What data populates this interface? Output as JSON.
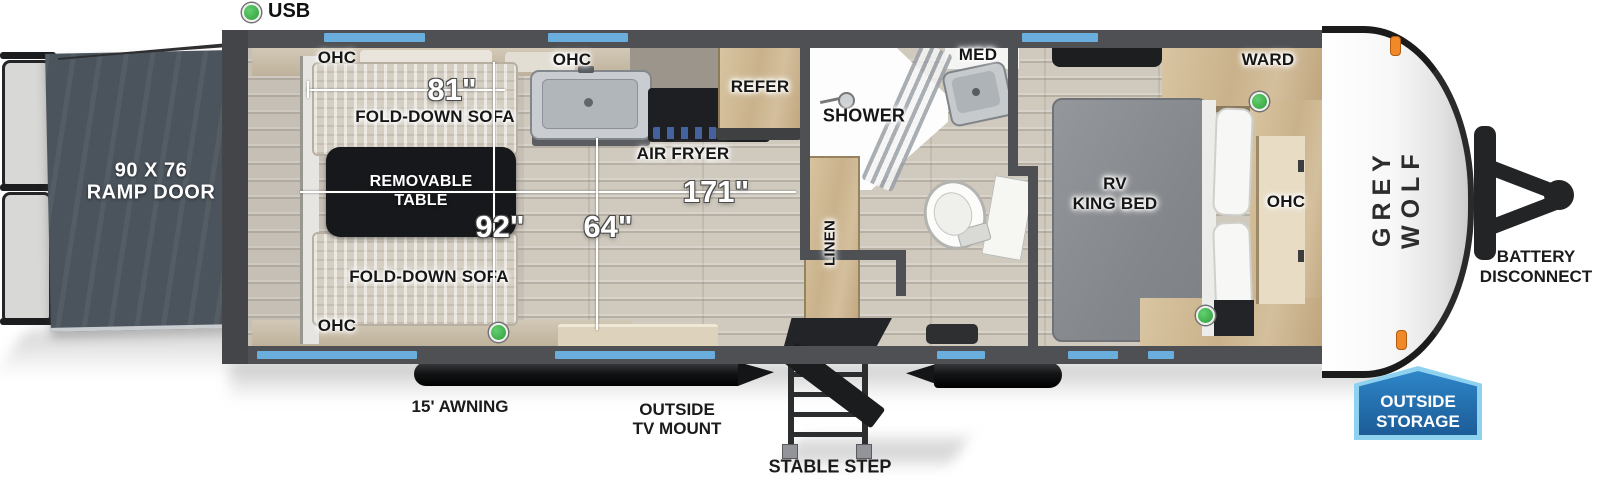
{
  "indicators": {
    "usb": "USB"
  },
  "garage": {
    "ramp_size": "90 X 76",
    "ramp_name": "RAMP DOOR",
    "ohc": "OHC",
    "sofa": "FOLD-DOWN SOFA",
    "table_l1": "REMOVABLE",
    "table_l2": "TABLE"
  },
  "kitchen": {
    "ohc": "OHC",
    "air_fryer": "AIR FRYER",
    "refer": "REFER"
  },
  "bathroom": {
    "shower": "SHOWER",
    "med": "MED",
    "linen": "LINEN"
  },
  "bedroom": {
    "bed_l1": "RV",
    "bed_l2": "KING BED",
    "ward": "WARD",
    "ohc": "OHC"
  },
  "dimensions": {
    "sofa_length": "81\"",
    "interior_width": "92\"",
    "main_length": "171\"",
    "aisle_width": "64\""
  },
  "exterior": {
    "awning": "15' AWNING",
    "tv_mount_l1": "OUTSIDE",
    "tv_mount_l2": "TV MOUNT",
    "stable_step": "STABLE STEP",
    "battery_l1": "BATTERY",
    "battery_l2": "DISCONNECT",
    "storage_l1": "OUTSIDE",
    "storage_l2": "STORAGE",
    "brand": "GREY WOLF"
  },
  "colors": {
    "window_blue": "#6aaede",
    "usb_green": "#3cb54a",
    "storage_badge_fill": "#1c5c97",
    "storage_badge_border": "#8fd2f0",
    "marker_orange": "#f08a28",
    "wall_gray": "#4e5054",
    "ramp_slate": "#4b535c",
    "table_black": "#17181b"
  }
}
